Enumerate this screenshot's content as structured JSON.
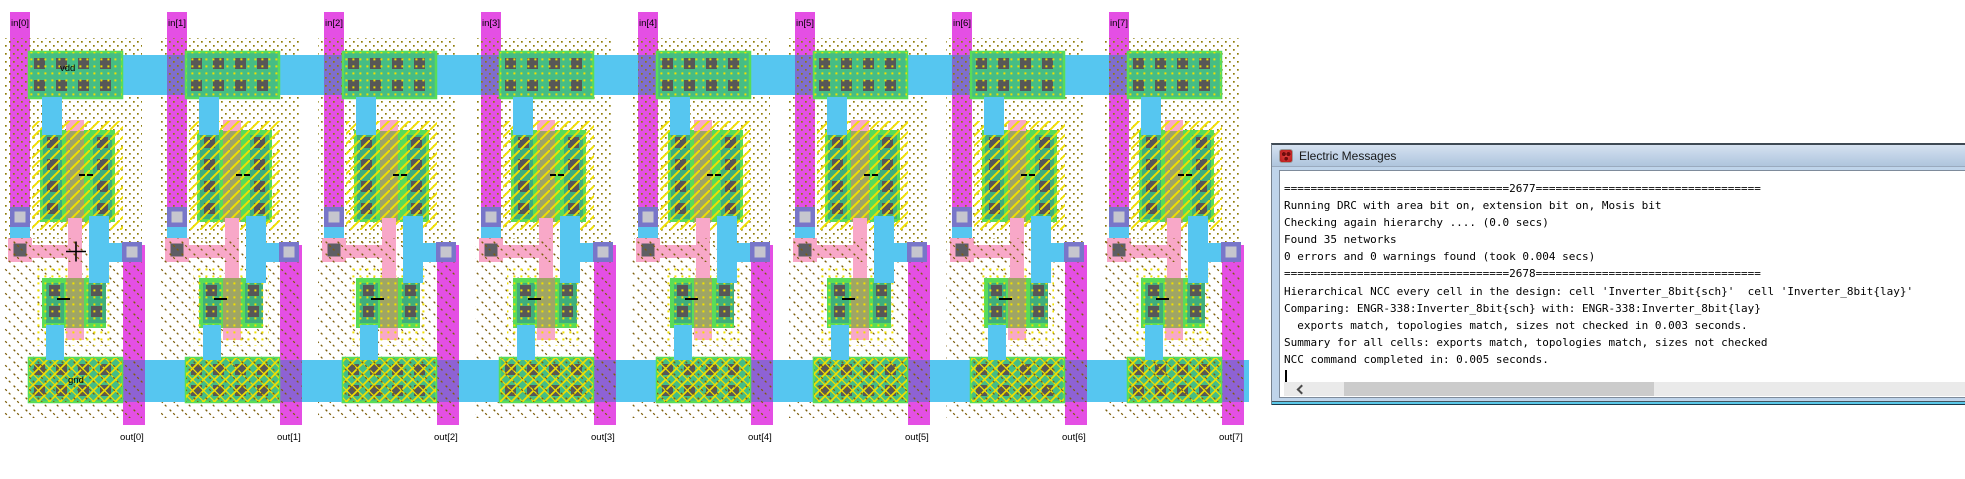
{
  "messages_window": {
    "title": "Electric Messages",
    "console_lines": [
      "==================================2677==================================",
      "Running DRC with area bit on, extension bit on, Mosis bit",
      "Checking again hierarchy .... (0.0 secs)",
      "Found 35 networks",
      "0 errors and 0 warnings found (took 0.004 secs)",
      "==================================2678==================================",
      "Hierarchical NCC every cell in the design: cell 'Inverter_8bit{sch}'  cell 'Inverter_8bit{lay}'",
      "Comparing: ENGR-338:Inverter_8bit{sch} with: ENGR-338:Inverter_8bit{lay}",
      "  exports match, topologies match, sizes not checked in 0.003 seconds.",
      "Summary for all cells: exports match, topologies match, sizes not checked",
      "NCC command completed in: 0.005 seconds."
    ]
  },
  "layout_editor": {
    "power_label": "vdd",
    "ground_label": "gnd",
    "cells": [
      {
        "in_label": "in[0]",
        "out_label": "out[0]"
      },
      {
        "in_label": "in[1]",
        "out_label": "out[1]"
      },
      {
        "in_label": "in[2]",
        "out_label": "out[2]"
      },
      {
        "in_label": "in[3]",
        "out_label": "out[3]"
      },
      {
        "in_label": "in[4]",
        "out_label": "out[4]"
      },
      {
        "in_label": "in[5]",
        "out_label": "out[5]"
      },
      {
        "in_label": "in[6]",
        "out_label": "out[6]"
      },
      {
        "in_label": "in[7]",
        "out_label": "out[7]"
      }
    ],
    "colors": {
      "metal2_magenta": "#E44FE4",
      "metal1_cyan": "#56C6F0",
      "active_green": "#58DC58",
      "active_metal_teal": "#45BD85",
      "transistor_col_teal": "#3FAE7C",
      "poly_pink": "#F8A8C8",
      "poly_over_active_olive": "#9FA565",
      "contact_gray": "#575757",
      "via_outer_purple": "#7876C9",
      "via_inner_gray": "#C6C6CE",
      "select_yellow": "#F0E000",
      "nwell_dot_brown": "#8F7D0A",
      "pwell_line_brown": "#7D5F0C",
      "m2_over_m1_blend": "#7F6ECC",
      "m2_over_gndbus_blend": "#8E62D4"
    }
  }
}
